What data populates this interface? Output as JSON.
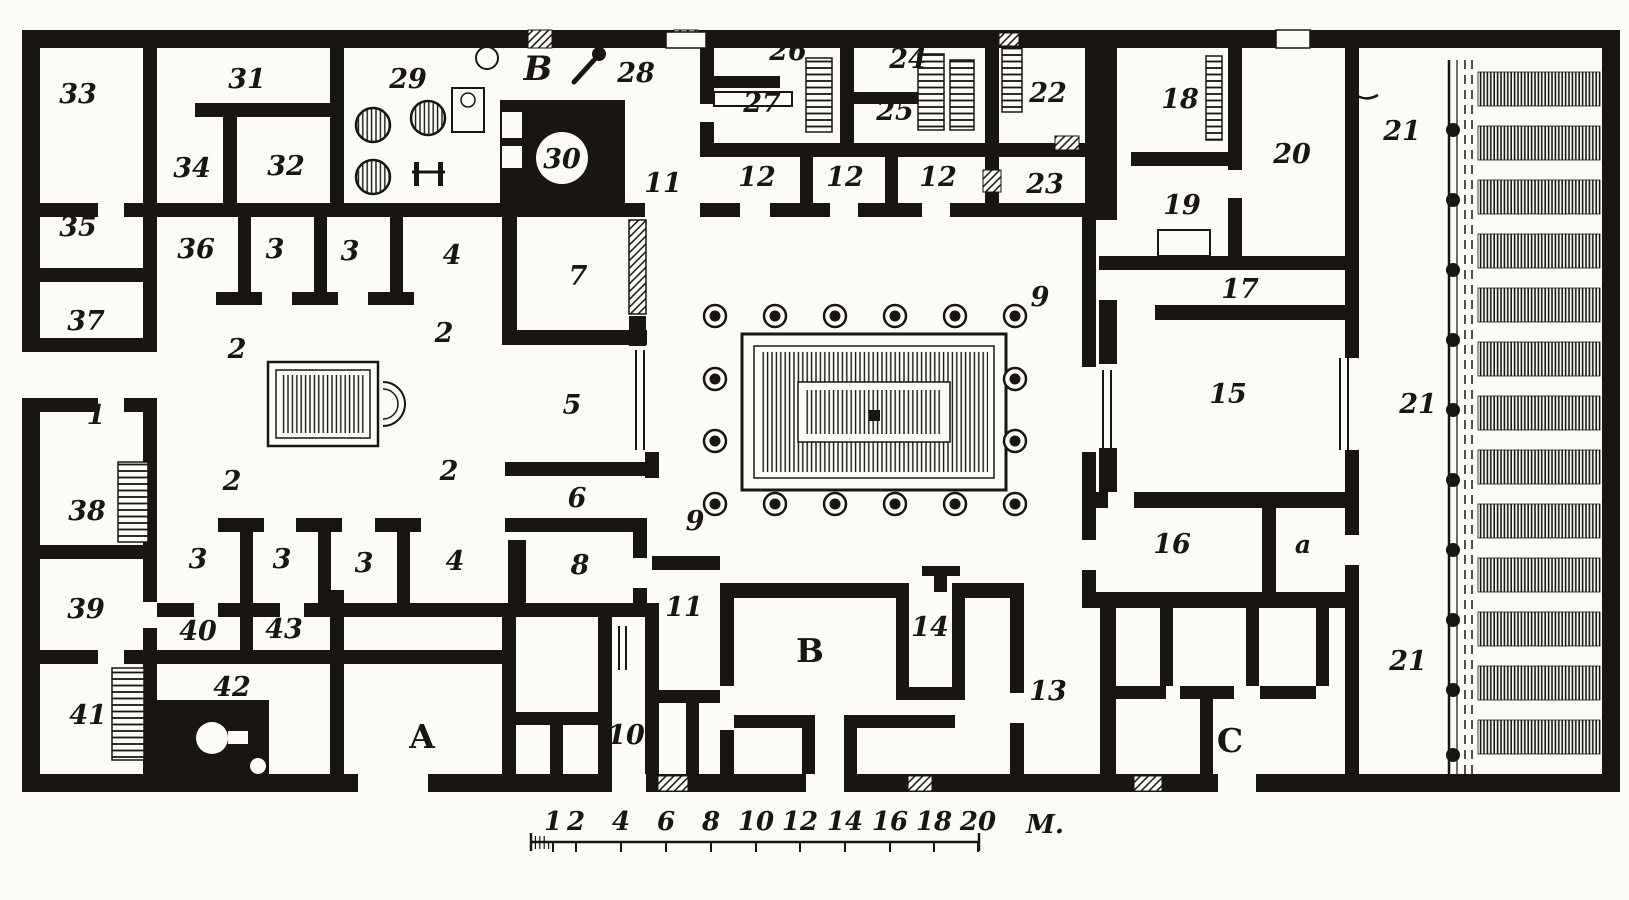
{
  "plan": {
    "description_labels_note": "engraved floor plan, black ink on paper",
    "colors": {
      "ink": "#181512",
      "paper": "#fcfbf7"
    },
    "counts": {
      "peristyle_columns": 16,
      "garden_colonnade_columns": 10,
      "garden_bed_rows": 13,
      "bakery_mills": 3
    },
    "room_labels": [
      {
        "t": "33",
        "x": 78,
        "y": 103
      },
      {
        "t": "31",
        "x": 247,
        "y": 88
      },
      {
        "t": "29",
        "x": 408,
        "y": 88
      },
      {
        "t": "B",
        "x": 538,
        "y": 80,
        "k": "script",
        "name": "label-B-script"
      },
      {
        "t": "28",
        "x": 636,
        "y": 82
      },
      {
        "t": "26",
        "x": 788,
        "y": 60
      },
      {
        "t": "27",
        "x": 762,
        "y": 112
      },
      {
        "t": "24",
        "x": 908,
        "y": 68
      },
      {
        "t": "25",
        "x": 895,
        "y": 120
      },
      {
        "t": "22",
        "x": 1048,
        "y": 102
      },
      {
        "t": "18",
        "x": 1180,
        "y": 108
      },
      {
        "t": "20",
        "x": 1292,
        "y": 163
      },
      {
        "t": "21",
        "x": 1402,
        "y": 140
      },
      {
        "t": "34",
        "x": 192,
        "y": 177
      },
      {
        "t": "32",
        "x": 286,
        "y": 175
      },
      {
        "t": "30",
        "x": 562,
        "y": 168
      },
      {
        "t": "11",
        "x": 663,
        "y": 192
      },
      {
        "t": "12",
        "x": 757,
        "y": 186
      },
      {
        "t": "12",
        "x": 845,
        "y": 186
      },
      {
        "t": "12",
        "x": 938,
        "y": 186
      },
      {
        "t": "23",
        "x": 1045,
        "y": 193
      },
      {
        "t": "19",
        "x": 1182,
        "y": 214
      },
      {
        "t": "35",
        "x": 78,
        "y": 236
      },
      {
        "t": "36",
        "x": 196,
        "y": 258
      },
      {
        "t": "3",
        "x": 275,
        "y": 258
      },
      {
        "t": "3",
        "x": 350,
        "y": 260
      },
      {
        "t": "4",
        "x": 452,
        "y": 264
      },
      {
        "t": "7",
        "x": 578,
        "y": 285
      },
      {
        "t": "17",
        "x": 1240,
        "y": 298
      },
      {
        "t": "37",
        "x": 86,
        "y": 330
      },
      {
        "t": "2",
        "x": 237,
        "y": 358
      },
      {
        "t": "2",
        "x": 444,
        "y": 342
      },
      {
        "t": "9",
        "x": 1040,
        "y": 306
      },
      {
        "t": "1",
        "x": 96,
        "y": 424
      },
      {
        "t": "5",
        "x": 572,
        "y": 414
      },
      {
        "t": "15",
        "x": 1228,
        "y": 403
      },
      {
        "t": "21",
        "x": 1418,
        "y": 413
      },
      {
        "t": "2",
        "x": 232,
        "y": 490
      },
      {
        "t": "2",
        "x": 449,
        "y": 480
      },
      {
        "t": "38",
        "x": 87,
        "y": 520
      },
      {
        "t": "6",
        "x": 577,
        "y": 507
      },
      {
        "t": "9",
        "x": 695,
        "y": 530
      },
      {
        "t": "16",
        "x": 1172,
        "y": 553
      },
      {
        "t": "a",
        "x": 1303,
        "y": 553,
        "k": "small"
      },
      {
        "t": "3",
        "x": 198,
        "y": 568
      },
      {
        "t": "3",
        "x": 282,
        "y": 568
      },
      {
        "t": "3",
        "x": 364,
        "y": 572
      },
      {
        "t": "4",
        "x": 455,
        "y": 570
      },
      {
        "t": "8",
        "x": 580,
        "y": 574
      },
      {
        "t": "39",
        "x": 86,
        "y": 618
      },
      {
        "t": "40",
        "x": 198,
        "y": 640
      },
      {
        "t": "43",
        "x": 284,
        "y": 638
      },
      {
        "t": "11",
        "x": 684,
        "y": 616
      },
      {
        "t": "14",
        "x": 930,
        "y": 636
      },
      {
        "t": "13",
        "x": 1048,
        "y": 700
      },
      {
        "t": "21",
        "x": 1408,
        "y": 670
      },
      {
        "t": "42",
        "x": 232,
        "y": 696
      },
      {
        "t": "A",
        "x": 422,
        "y": 748,
        "k": "letter",
        "name": "label-entrance-A"
      },
      {
        "t": "10",
        "x": 626,
        "y": 744
      },
      {
        "t": "41",
        "x": 88,
        "y": 724
      },
      {
        "t": "B",
        "x": 810,
        "y": 662,
        "k": "letter",
        "name": "label-entrance-B"
      },
      {
        "t": "C",
        "x": 1230,
        "y": 752,
        "k": "letter",
        "name": "label-entrance-C"
      }
    ],
    "scale_bar": {
      "unit_label": "M.",
      "ticks": [
        {
          "t": "1",
          "x": 553
        },
        {
          "t": "2",
          "x": 576
        },
        {
          "t": "4",
          "x": 621
        },
        {
          "t": "6",
          "x": 666
        },
        {
          "t": "8",
          "x": 711
        },
        {
          "t": "10",
          "x": 756
        },
        {
          "t": "12",
          "x": 800
        },
        {
          "t": "14",
          "x": 845
        },
        {
          "t": "16",
          "x": 890
        },
        {
          "t": "18",
          "x": 934
        },
        {
          "t": "20",
          "x": 978
        }
      ]
    }
  }
}
